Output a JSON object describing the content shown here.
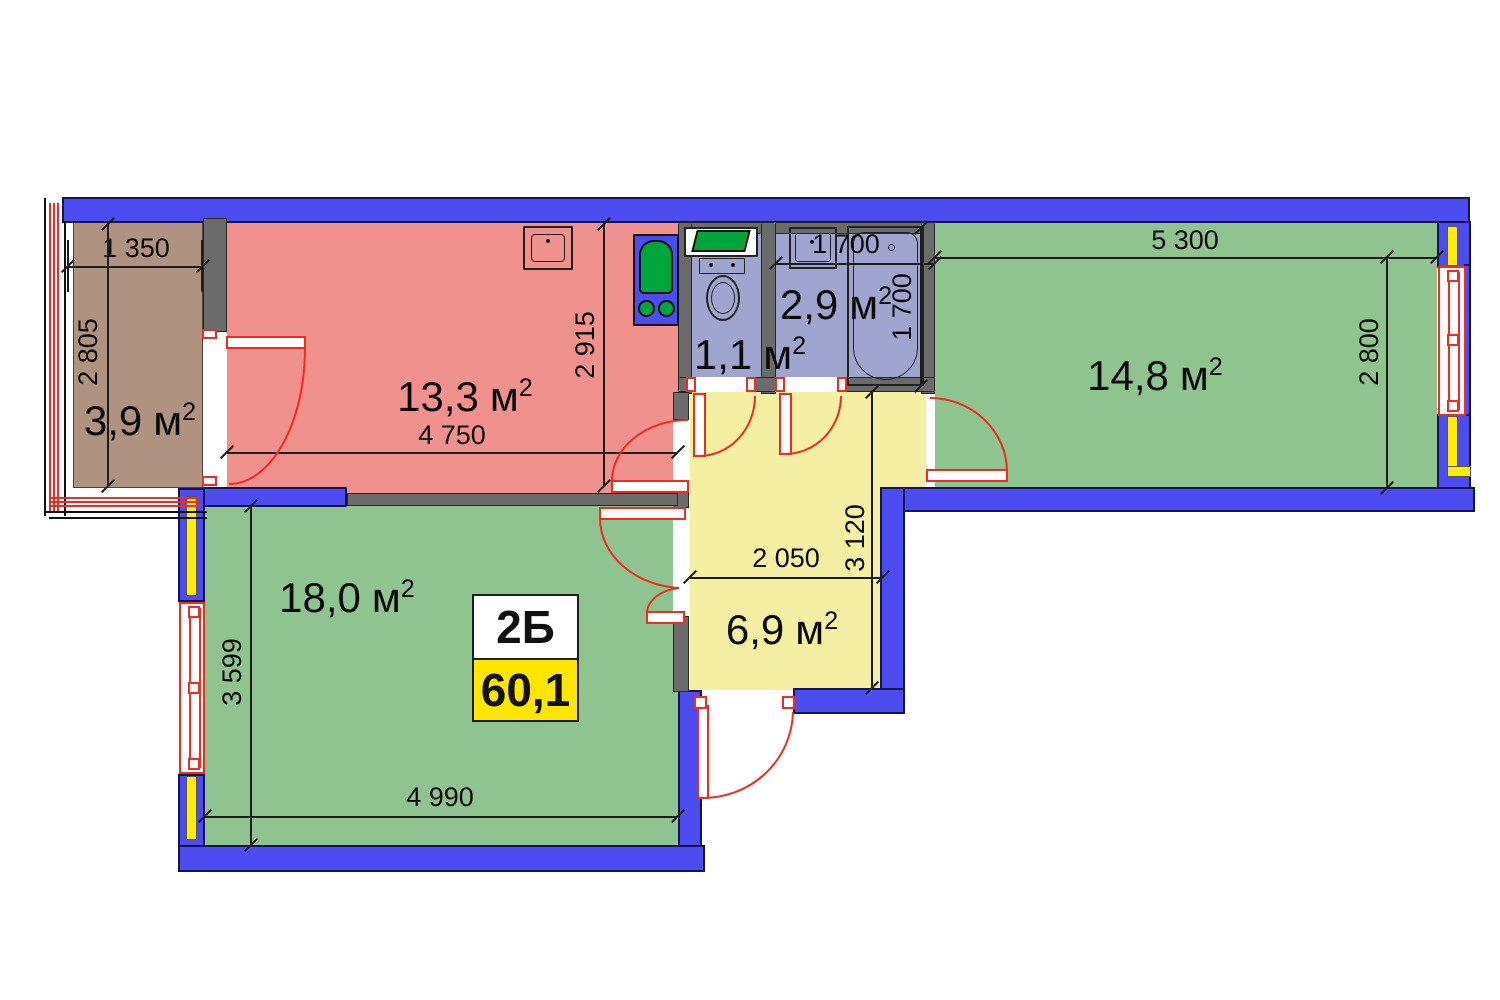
{
  "meta": {
    "apartment_type": "2Б",
    "total_area": "60,1",
    "area_unit": "м",
    "sup": "2"
  },
  "rooms": {
    "balcony": {
      "area": "3,9"
    },
    "kitchen": {
      "area": "13,3"
    },
    "wc": {
      "area": "1,1"
    },
    "bathroom": {
      "area": "2,9"
    },
    "living": {
      "area": "14,8"
    },
    "bedroom": {
      "area": "18,0"
    },
    "hallway": {
      "area": "6,9"
    }
  },
  "dimensions": {
    "balcony_width": "1 350",
    "balcony_height": "2 805",
    "kitchen_width": "4 750",
    "kitchen_height": "2 915",
    "bathroom_width": "1 700",
    "bathroom_height": "1 700",
    "living_width": "5 300",
    "living_height": "2 800",
    "bedroom_width": "4 990",
    "bedroom_height": "3 599",
    "hallway_width": "2 050",
    "hallway_height": "3 120"
  },
  "colors": {
    "wall_blue": "#4c4cf0",
    "insulation_yellow": "#ffee00",
    "partition_gray": "#6b6b6b",
    "kitchen_red": "#f0918d",
    "room_green": "#8fc38f",
    "hallway_yellow": "#f4efa2",
    "bathroom_lavender": "#9fa5cf",
    "balcony_brown": "#b09280",
    "door_red": "#f22b20",
    "fixture_green": "#00a53c",
    "label_yellow": "#ffe500"
  }
}
